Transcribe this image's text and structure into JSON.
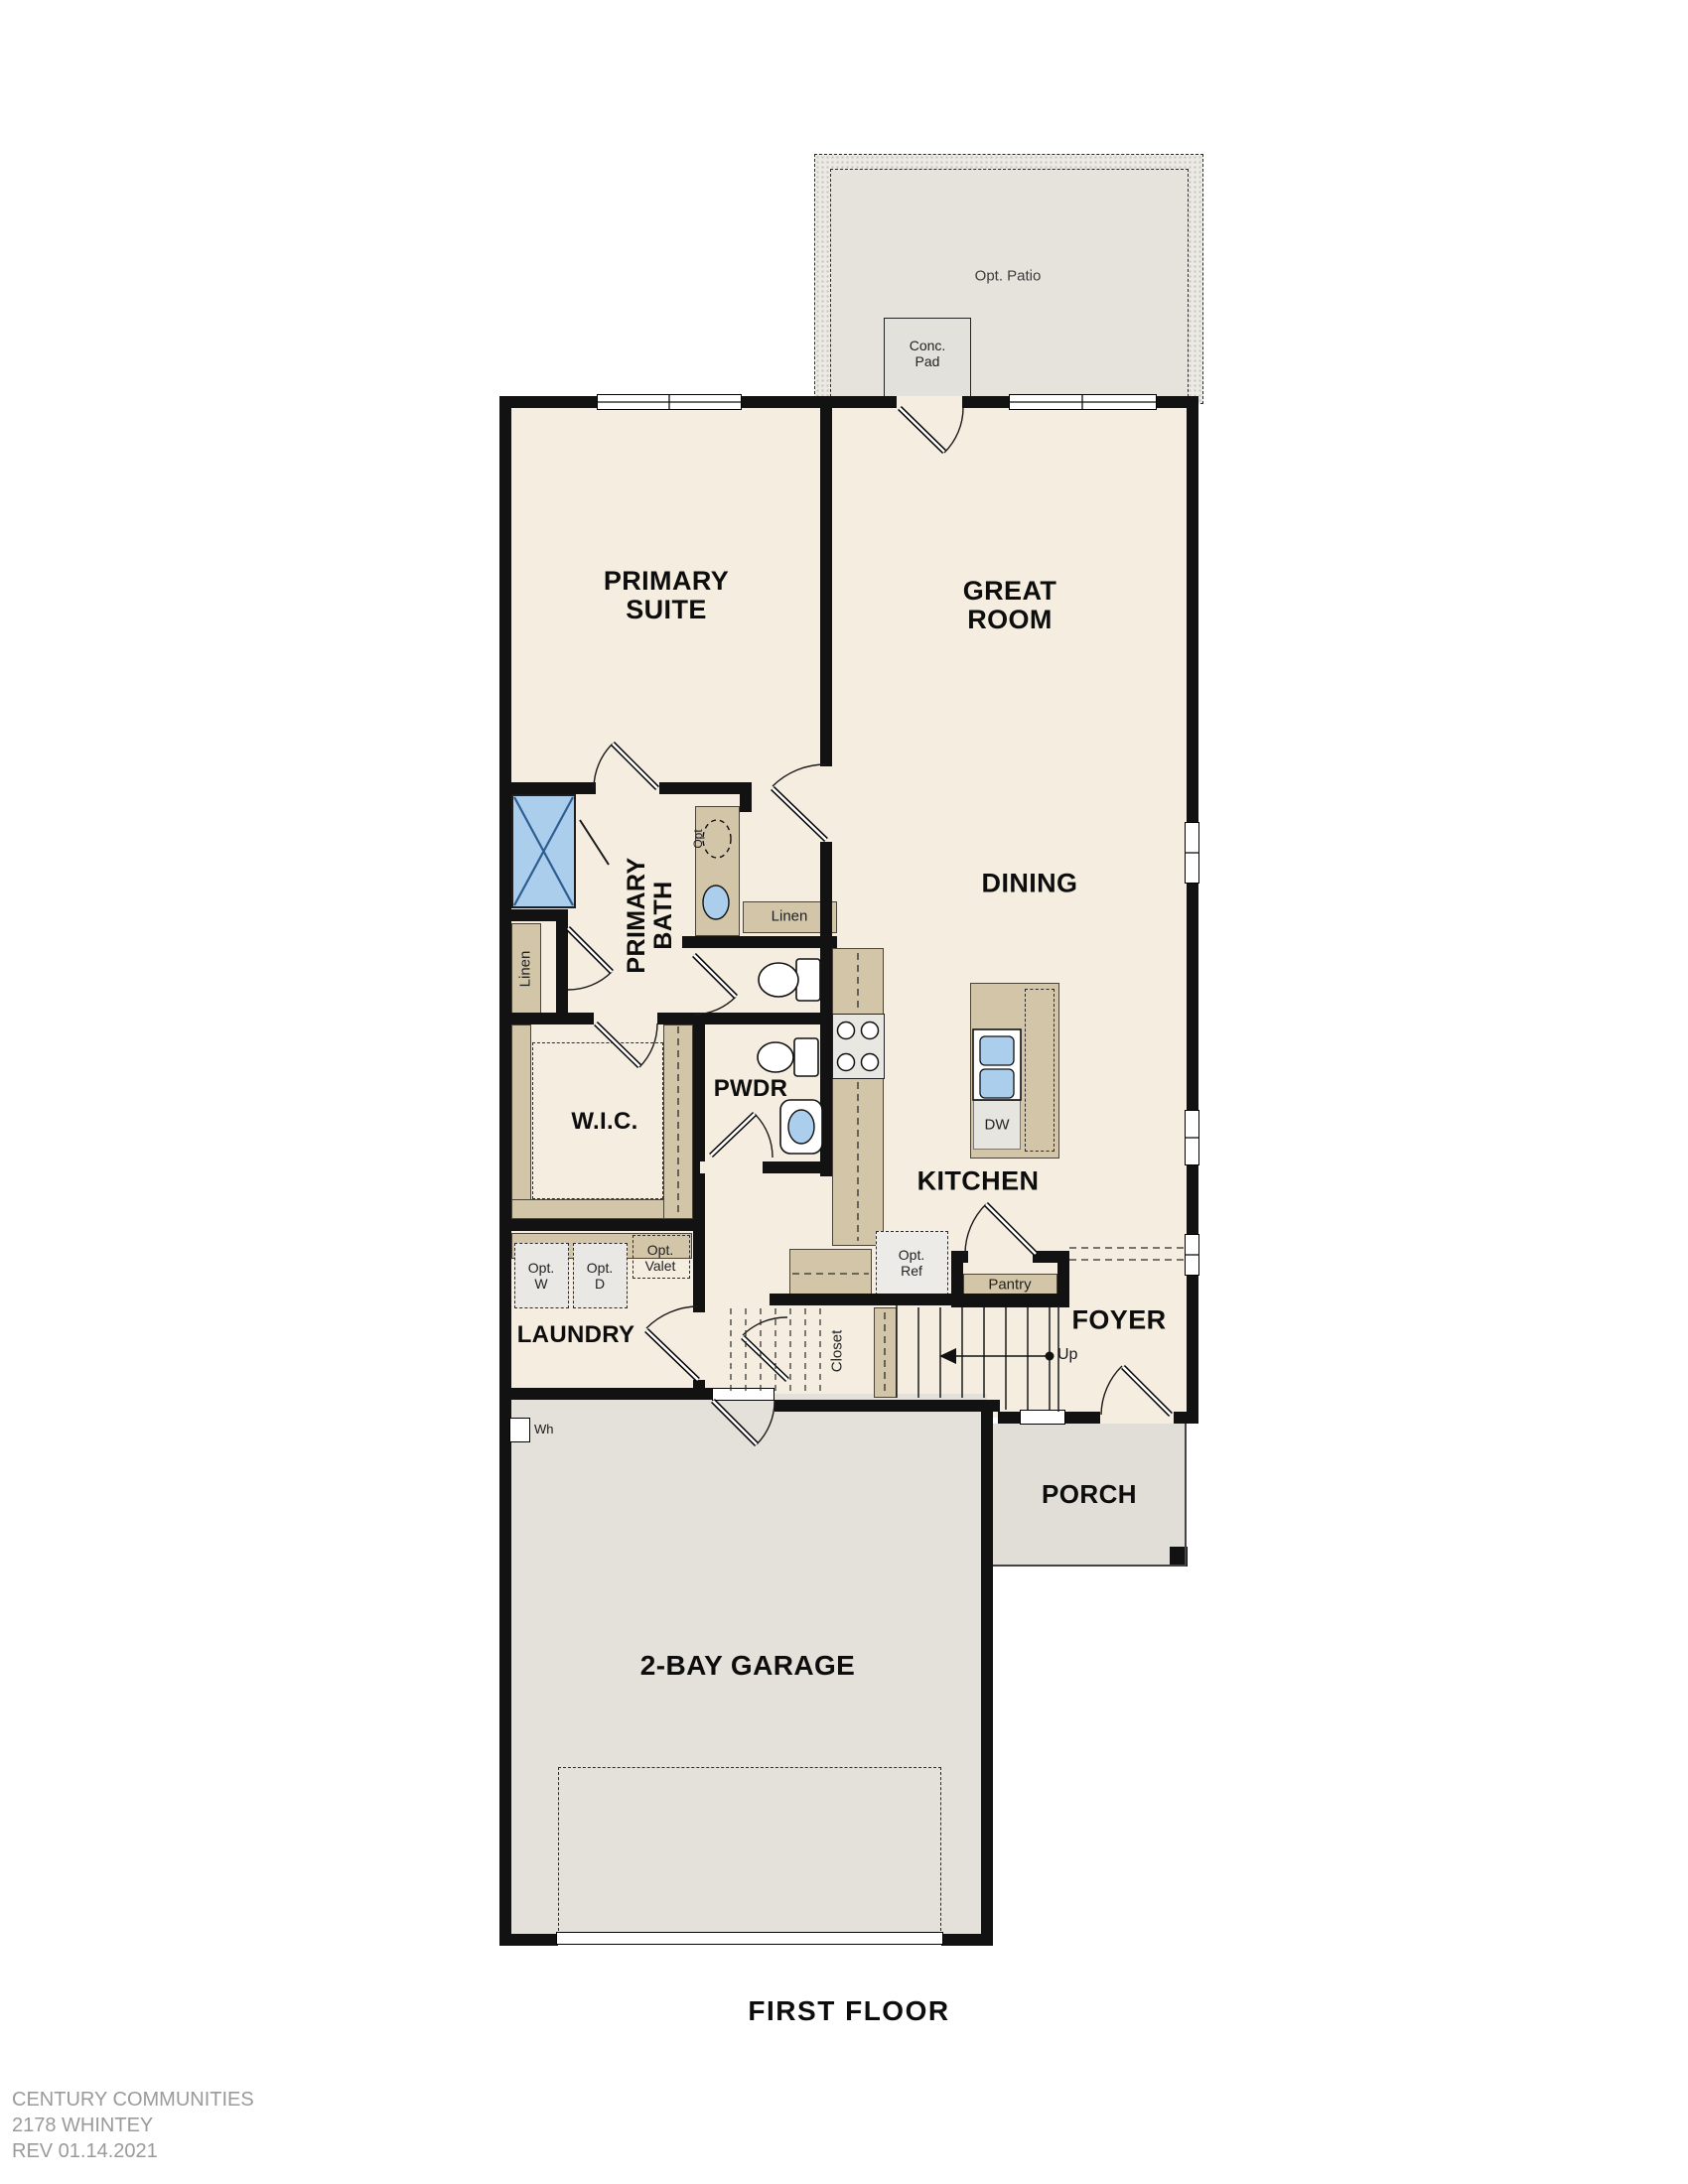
{
  "meta": {
    "floor_title": "FIRST FLOOR"
  },
  "footer": {
    "company": "CENTURY COMMUNITIES",
    "plan_name": "2178 WHINTEY",
    "revision": "REV 01.14.2021"
  },
  "colors": {
    "floor_cream": "#f5eee0",
    "wall_black": "#121212",
    "cabinet_tan": "#d3c5a7",
    "fixture_blue": "#abceec",
    "patio_gray": "#e6e3dd",
    "garage_gray": "#e4e1db",
    "footer_gray": "#9a9a9a"
  },
  "rooms": {
    "primary_suite": "PRIMARY SUITE",
    "great_room": "GREAT ROOM",
    "dining": "DINING",
    "primary_bath": "PRIMARY BATH",
    "wic": "W.I.C.",
    "pwdr": "PWDR",
    "kitchen": "KITCHEN",
    "laundry": "LAUNDRY",
    "foyer": "FOYER",
    "porch": "PORCH",
    "garage": "2-BAY GARAGE"
  },
  "features": {
    "opt_patio": "Opt. Patio",
    "conc_pad": "Conc. Pad",
    "linen_bath": "Linen",
    "linen_hall": "Linen",
    "opt_sink": "Opt",
    "dw": "DW",
    "opt_ref": "Opt. Ref",
    "pantry": "Pantry",
    "opt_washer": "Opt. W",
    "opt_dryer": "Opt. D",
    "opt_valet": "Opt. Valet",
    "closet": "Closet",
    "up": "Up",
    "water_heater": "Wh"
  }
}
